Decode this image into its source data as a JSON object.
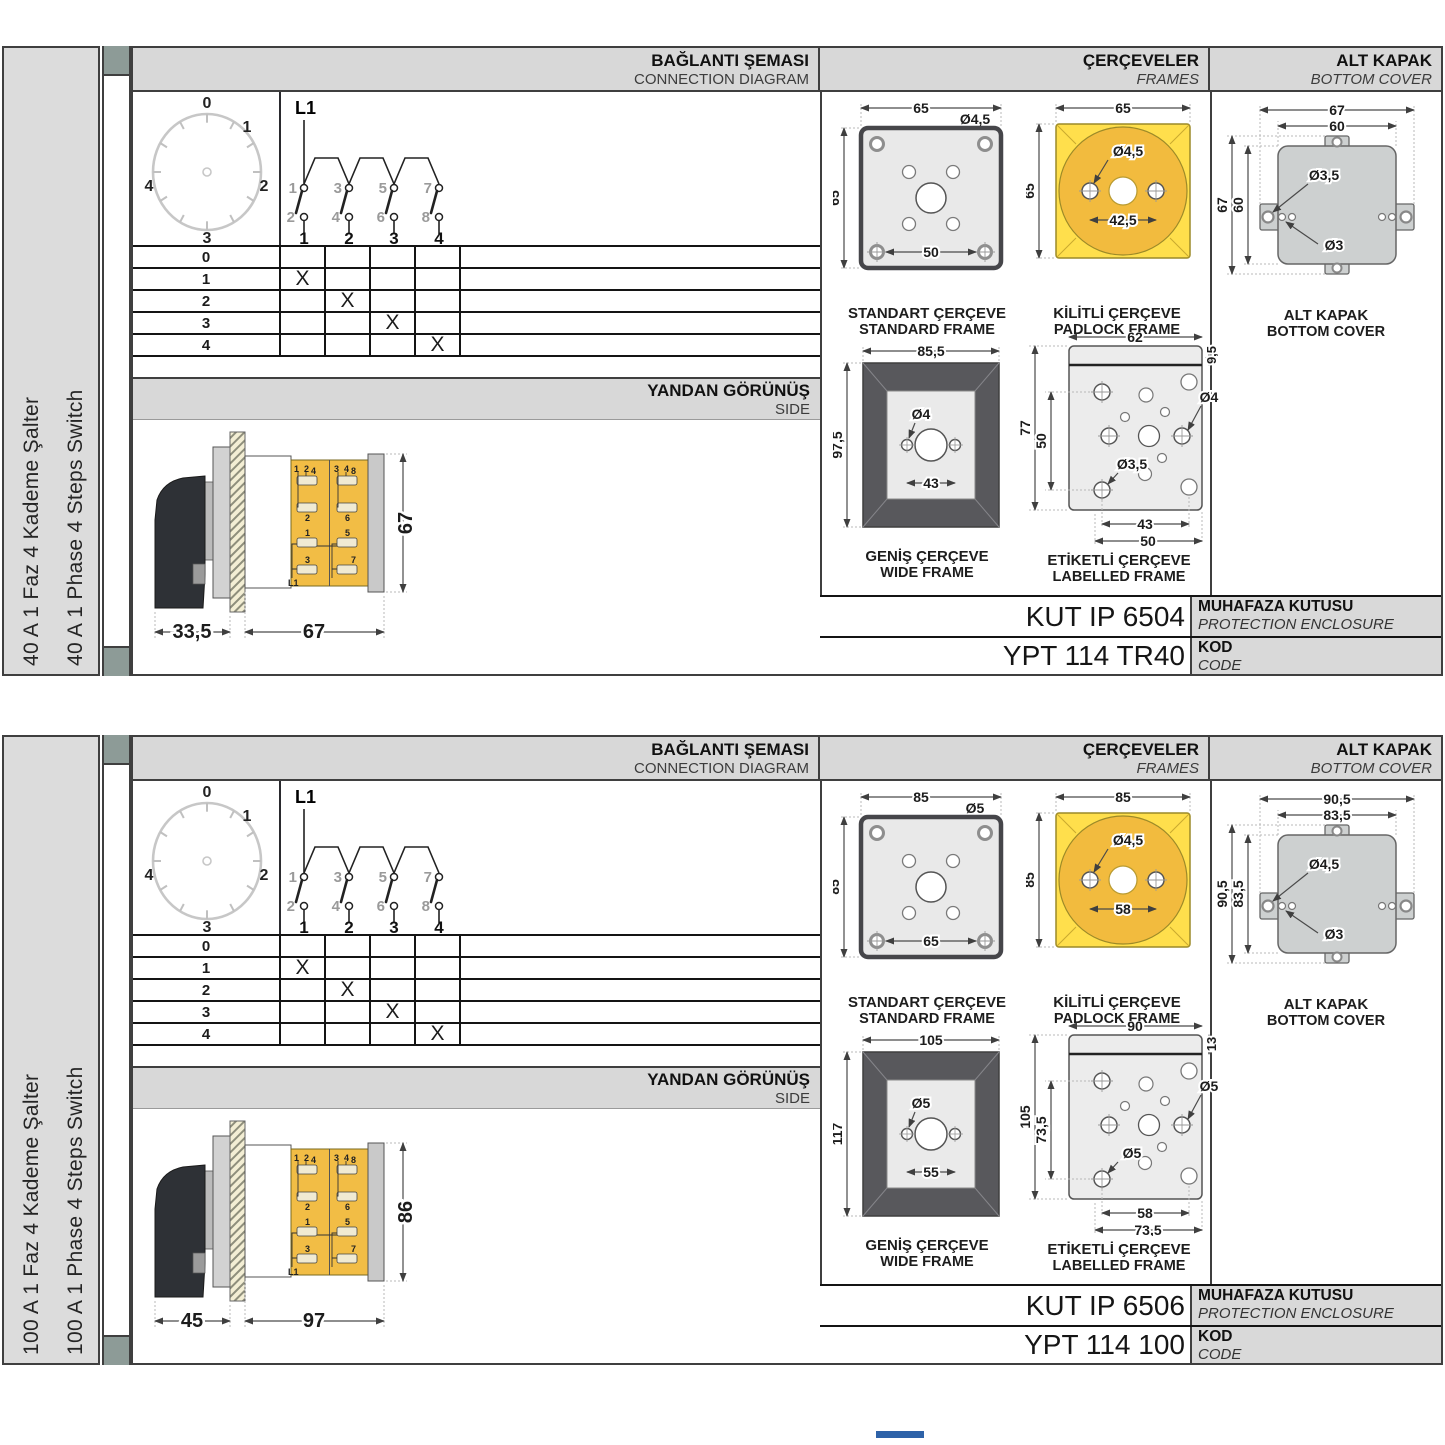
{
  "colors": {
    "accent_yellow": "#f2bb3e",
    "panel_gray": "#d8d8d8",
    "footer_blue": "#2e62a8"
  },
  "panels": [
    {
      "sidebar": {
        "title_tr": "40 A 1 Faz 4 Kademe Şalter",
        "title_en": "40 A 1 Phase 4 Steps Switch"
      },
      "conn": {
        "h_tr": "BAĞLANTI ŞEMASI",
        "h_en": "CONNECTION DIAGRAM",
        "dial": [
          "0",
          "1",
          "2",
          "3",
          "4"
        ],
        "circ": {
          "l1": "L1",
          "up": [
            "1",
            "3",
            "5",
            "7"
          ],
          "low": [
            "2",
            "4",
            "6",
            "8"
          ],
          "term": [
            "1",
            "2",
            "3",
            "4"
          ]
        },
        "rows": [
          {
            "label": "0",
            "m": [
              "",
              "",
              "",
              ""
            ]
          },
          {
            "label": "1",
            "m": [
              "X",
              "",
              "",
              ""
            ]
          },
          {
            "label": "2",
            "m": [
              "",
              "X",
              "",
              ""
            ]
          },
          {
            "label": "3",
            "m": [
              "",
              "",
              "X",
              ""
            ]
          },
          {
            "label": "4",
            "m": [
              "",
              "",
              "",
              "X"
            ]
          }
        ],
        "side_tr": "YANDAN GÖRÜNÜŞ",
        "side_en": "SIDE"
      },
      "side": {
        "d_front": "33,5",
        "d_body": "67",
        "d_height": "67",
        "ta": [
          "1",
          "2"
        ],
        "tb": [
          "3",
          "4"
        ],
        "ca": [
          "4",
          "2",
          "1",
          "3"
        ],
        "cb": [
          "8",
          "6",
          "5",
          "7"
        ],
        "feed": "L1"
      },
      "frames": {
        "h_tr": "ÇERÇEVELER",
        "h_en": "FRAMES",
        "std": {
          "w": "65",
          "h": "65",
          "hole": "Ø4,5",
          "pitch": "50",
          "c1": "STANDART ÇERÇEVE",
          "c2": "STANDARD FRAME"
        },
        "pad": {
          "w": "65",
          "h": "65",
          "hole": "Ø4,5",
          "pitch": "42,5",
          "c1": "KİLİTLİ ÇERÇEVE",
          "c2": "PADLOCK FRAME"
        },
        "wide": {
          "w": "85,5",
          "h": "97,5",
          "hole": "Ø4",
          "pitch": "43",
          "c1": "GENİŞ ÇERÇEVE",
          "c2": "WIDE FRAME"
        },
        "lab": {
          "w": "62",
          "strip": "9,5",
          "h": "77",
          "pv": "50",
          "hole_r": "Ø4",
          "hole_b": "Ø3,5",
          "p1": "43",
          "p2": "50",
          "c1": "ETİKETLİ ÇERÇEVE",
          "c2": "LABELLED FRAME"
        }
      },
      "cover": {
        "h_tr": "ALT KAPAK",
        "h_en": "BOTTOM COVER",
        "wo": "67",
        "wi": "60",
        "ho": "67",
        "hi": "60",
        "h_tab": "Ø3,5",
        "h_sm": "Ø3",
        "c1": "ALT KAPAK",
        "c2": "BOTTOM COVER"
      },
      "codes": {
        "enc": "KUT IP 6504",
        "enc_tr": "MUHAFAZA KUTUSU",
        "enc_en": "PROTECTION ENCLOSURE",
        "code": "YPT 114 TR40",
        "code_tr": "KOD",
        "code_en": "CODE"
      }
    },
    {
      "sidebar": {
        "title_tr": "100 A 1 Faz 4 Kademe Şalter",
        "title_en": "100 A 1 Phase 4 Steps Switch"
      },
      "conn": {
        "h_tr": "BAĞLANTI ŞEMASI",
        "h_en": "CONNECTION DIAGRAM",
        "dial": [
          "0",
          "1",
          "2",
          "3",
          "4"
        ],
        "circ": {
          "l1": "L1",
          "up": [
            "1",
            "3",
            "5",
            "7"
          ],
          "low": [
            "2",
            "4",
            "6",
            "8"
          ],
          "term": [
            "1",
            "2",
            "3",
            "4"
          ]
        },
        "rows": [
          {
            "label": "0",
            "m": [
              "",
              "",
              "",
              ""
            ]
          },
          {
            "label": "1",
            "m": [
              "X",
              "",
              "",
              ""
            ]
          },
          {
            "label": "2",
            "m": [
              "",
              "X",
              "",
              ""
            ]
          },
          {
            "label": "3",
            "m": [
              "",
              "",
              "X",
              ""
            ]
          },
          {
            "label": "4",
            "m": [
              "",
              "",
              "",
              "X"
            ]
          }
        ],
        "side_tr": "YANDAN GÖRÜNÜŞ",
        "side_en": "SIDE"
      },
      "side": {
        "d_front": "45",
        "d_body": "97",
        "d_height": "86",
        "ta": [
          "1",
          "2"
        ],
        "tb": [
          "3",
          "4"
        ],
        "ca": [
          "4",
          "2",
          "1",
          "3"
        ],
        "cb": [
          "8",
          "6",
          "5",
          "7"
        ],
        "feed": "L1"
      },
      "frames": {
        "h_tr": "ÇERÇEVELER",
        "h_en": "FRAMES",
        "std": {
          "w": "85",
          "h": "85",
          "hole": "Ø5",
          "pitch": "65",
          "c1": "STANDART ÇERÇEVE",
          "c2": "STANDARD FRAME"
        },
        "pad": {
          "w": "85",
          "h": "85",
          "hole": "Ø4,5",
          "pitch": "58",
          "c1": "KİLİTLİ ÇERÇEVE",
          "c2": "PADLOCK FRAME"
        },
        "wide": {
          "w": "105",
          "h": "117",
          "hole": "Ø5",
          "pitch": "55",
          "c1": "GENİŞ ÇERÇEVE",
          "c2": "WIDE FRAME"
        },
        "lab": {
          "w": "90",
          "strip": "13",
          "h": "105",
          "pv": "73,5",
          "hole_r": "Ø5",
          "hole_b": "Ø5",
          "p1": "58",
          "p2": "73,5",
          "c1": "ETİKETLİ ÇERÇEVE",
          "c2": "LABELLED FRAME"
        }
      },
      "cover": {
        "h_tr": "ALT KAPAK",
        "h_en": "BOTTOM COVER",
        "wo": "90,5",
        "wi": "83,5",
        "ho": "90,5",
        "hi": "83,5",
        "h_tab": "Ø4,5",
        "h_sm": "Ø3",
        "c1": "ALT KAPAK",
        "c2": "BOTTOM COVER"
      },
      "codes": {
        "enc": "KUT IP 6506",
        "enc_tr": "MUHAFAZA KUTUSU",
        "enc_en": "PROTECTION ENCLOSURE",
        "code": "YPT 114 100",
        "code_tr": "KOD",
        "code_en": "CODE"
      }
    }
  ]
}
